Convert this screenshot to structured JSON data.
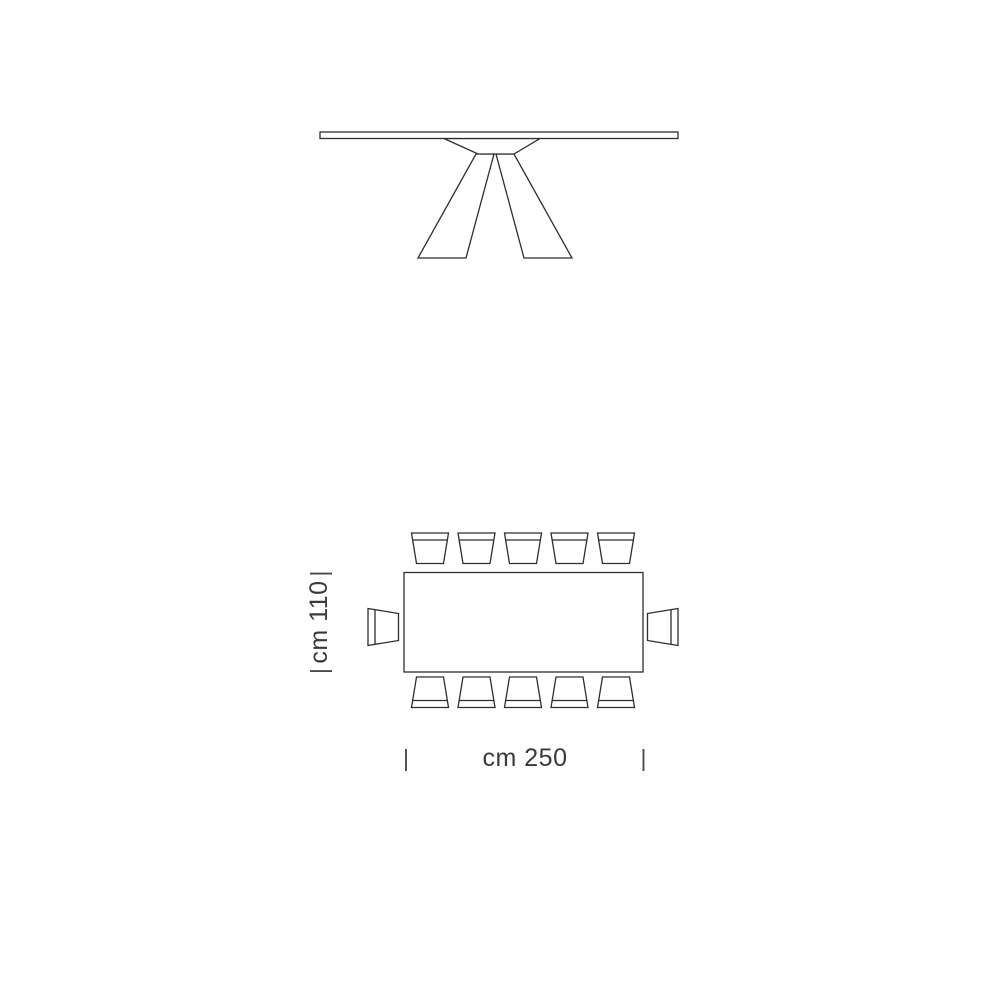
{
  "canvas": {
    "background": "#ffffff",
    "line_color": "#2e2e2e",
    "text_color": "#3a3a3a"
  },
  "plan_seating": {
    "top_row_chairs": 5,
    "bottom_row_chairs": 5,
    "left_end_chairs": 1,
    "right_end_chairs": 1,
    "total_chairs": 12
  },
  "dimensions": {
    "depth": {
      "label": "cm 110",
      "tick": "|"
    },
    "length": {
      "label": "cm 250",
      "tick": "|"
    }
  }
}
